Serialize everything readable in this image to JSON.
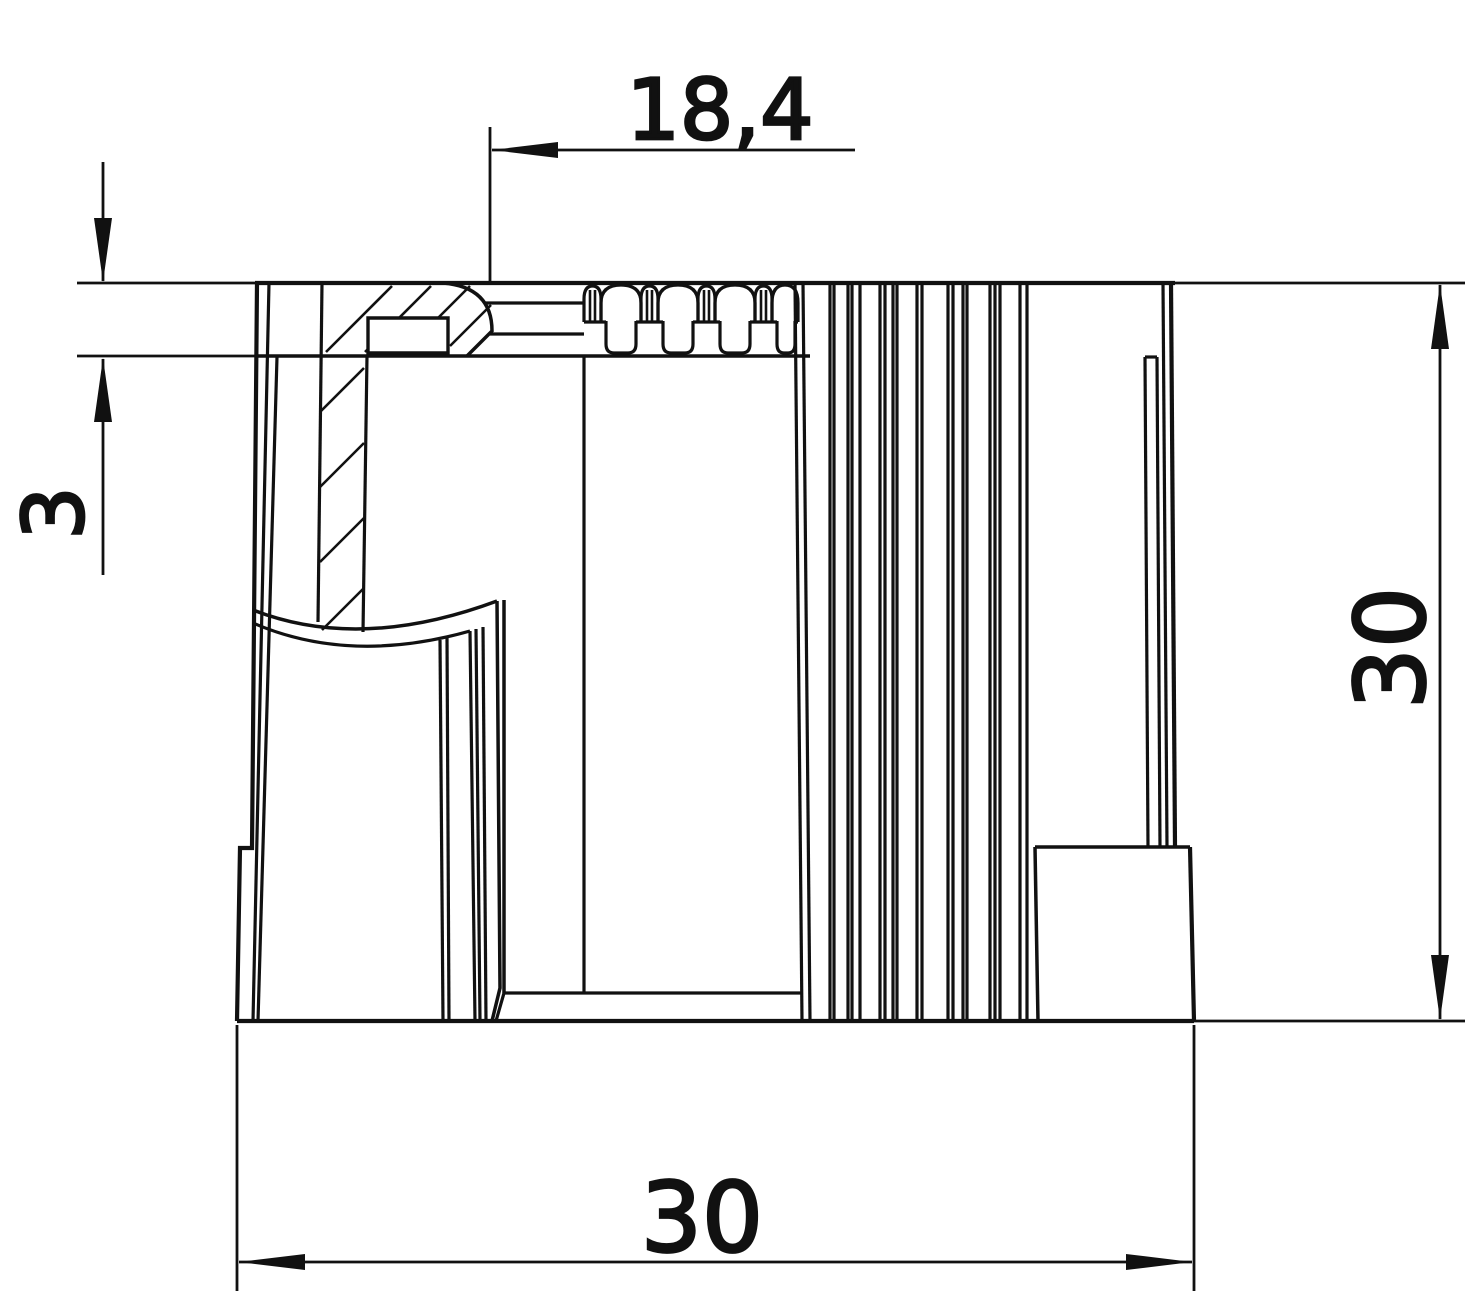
{
  "drawing": {
    "background": "#ffffff",
    "stroke_color": "#111111",
    "labels": {
      "top_offset": "18,4",
      "collar_thickness": "3",
      "overall_height": "30",
      "overall_width": "30"
    }
  }
}
